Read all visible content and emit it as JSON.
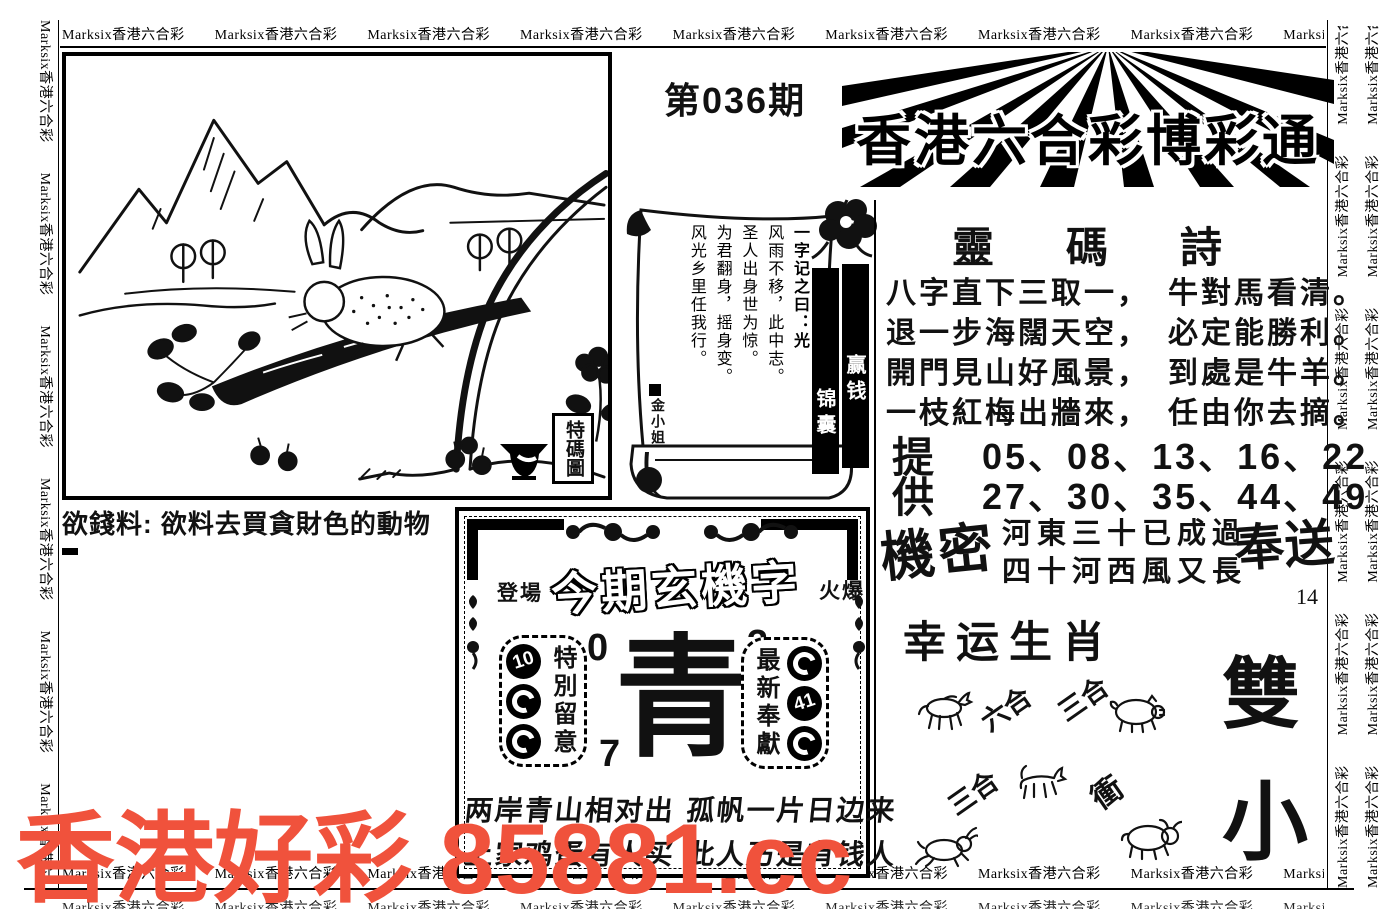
{
  "border": {
    "marquee": "Marksix香港六合彩"
  },
  "header": {
    "issue": "第036期",
    "masthead": "香港六合彩博彩通"
  },
  "picture": {
    "seal": "特碼圖",
    "caption": "欲錢料: 欲料去買貪財色的動物"
  },
  "scroll": {
    "intro": "一字记之曰：光",
    "lines": [
      "风雨不移，此中志。",
      "圣人出身世为惊。",
      "为君翻身，摇身变。",
      "风光乡里任我行。"
    ],
    "signature": "金小姐",
    "banner_right": "赢钱",
    "banner_left": "锦囊"
  },
  "poem": {
    "title": "靈碼詩",
    "lines": [
      "八字直下三取一，　牛對馬看清。",
      "退一步海闊天空，　必定能勝利。",
      "開門見山好風景，　到處是牛羊。",
      "一枝紅梅出牆來，　任由你去摘。"
    ],
    "provide_label_top": "提",
    "provide_label_bottom": "供",
    "numbers_top": "05、08、13、16、22",
    "numbers_bottom": "27、30、35、44、49"
  },
  "secret": {
    "label": "機密",
    "couplet_line1": "河東三十已成過",
    "couplet_line2": "四十河西風又長",
    "gift_label": "奉送",
    "page_number": "14"
  },
  "lucky": {
    "title": "幸运生肖",
    "label_liuhe": "六合",
    "label_sanhe_1": "三合",
    "label_sanhe_2": "三合",
    "label_chong": "衝",
    "size_char_top": "雙",
    "size_char_bottom": "小"
  },
  "mystery": {
    "tag_left": "登場",
    "title": "今期玄機字",
    "tag_right": "火爆",
    "special_label": "特別留意",
    "special_ball_1": "10",
    "newest_label": "最新奉獻",
    "newest_ball_2": "41",
    "main_char": "青",
    "num_top_left": "0",
    "num_top_right": "3",
    "num_bottom_left": "7",
    "num_bottom_right": "4",
    "verse_line1": "两岸青山相对出 孤帆一片日边来",
    "verse_line2": "上家鸡蛋有人买 此人乃是有钱人"
  },
  "watermark": {
    "text": "香港好彩 85881.cc",
    "color": "#f0523c"
  }
}
